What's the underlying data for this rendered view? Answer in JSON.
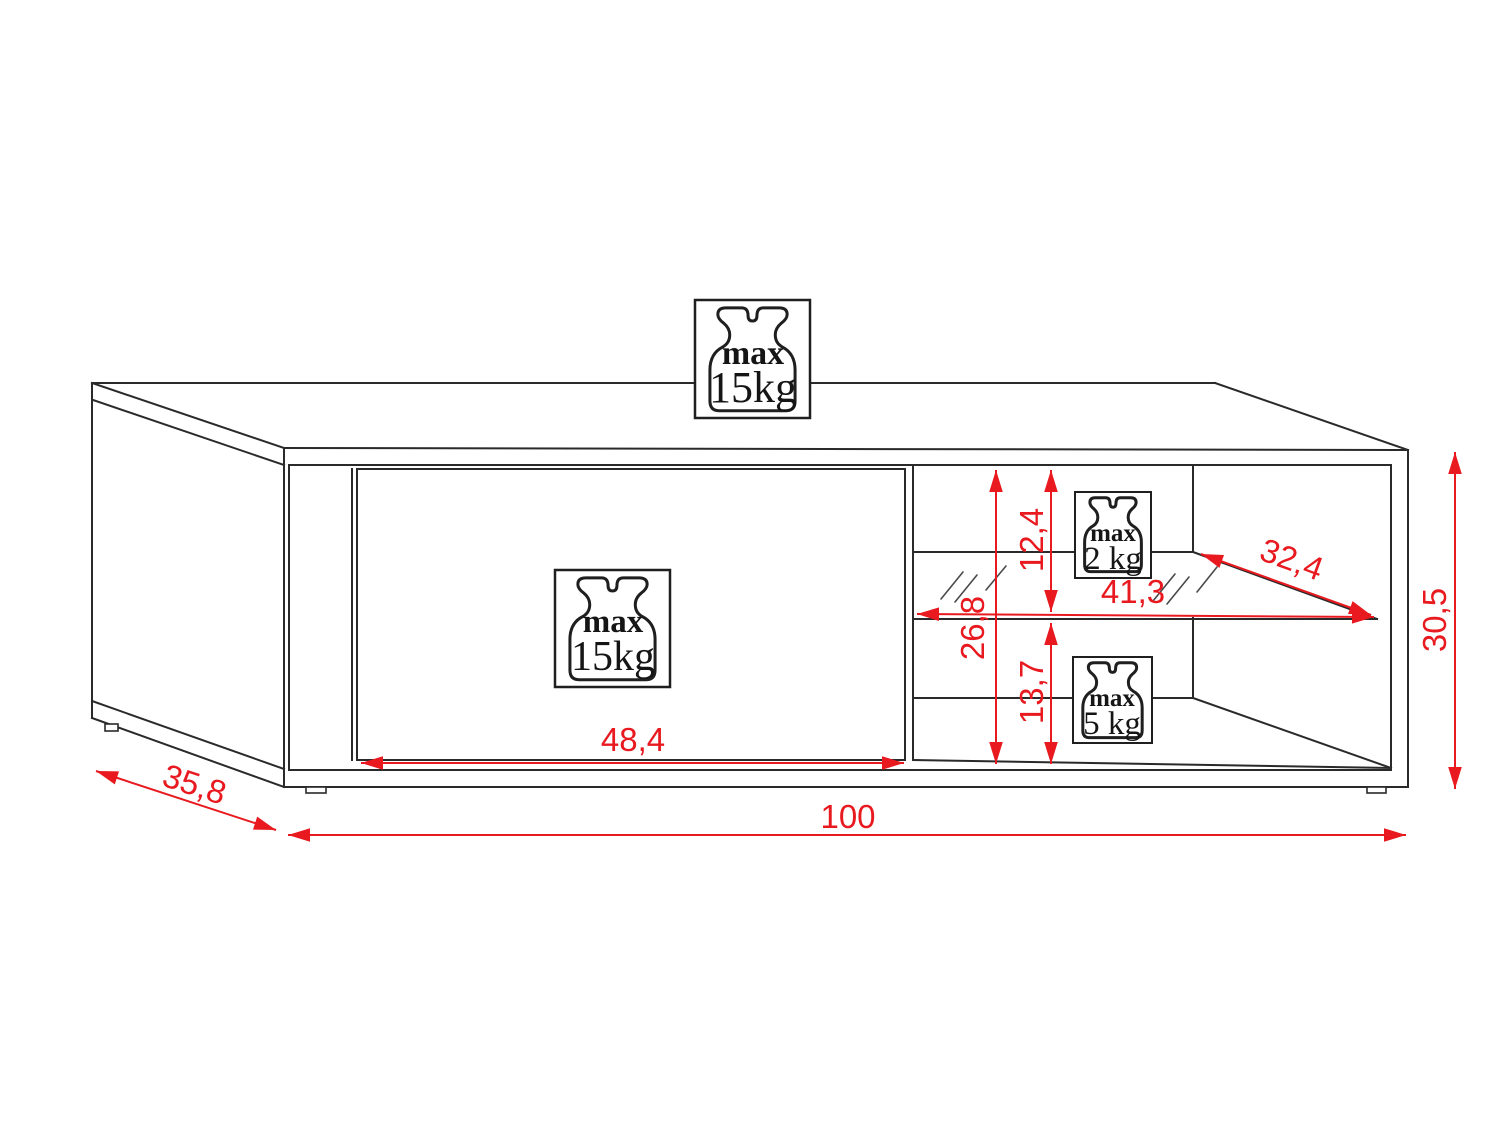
{
  "diagram": {
    "kind": "furniture-dimension-drawing",
    "subject": "TV cabinet with flap front and glass shelf, perspective line drawing with red dimensions"
  },
  "dimensions": {
    "total_width": "100",
    "total_depth": "35,8",
    "total_height": "30,5",
    "front_panel_width": "48,4",
    "interior_height": "26,8",
    "upper_opening_height": "12,4",
    "lower_opening_height": "13,7",
    "shelf_width": "41,3",
    "shelf_depth": "32,4"
  },
  "badges": {
    "top_panel": {
      "prefix": "max",
      "value": "15kg"
    },
    "front_panel": {
      "prefix": "max",
      "value": "15kg"
    },
    "glass_shelf": {
      "prefix": "max",
      "value": "2 kg"
    },
    "bottom_shelf": {
      "prefix": "max",
      "value": "5 kg"
    }
  },
  "colors": {
    "dimension_red": "#e8191f",
    "line_black": "#2a2a2a",
    "background": "#ffffff"
  }
}
